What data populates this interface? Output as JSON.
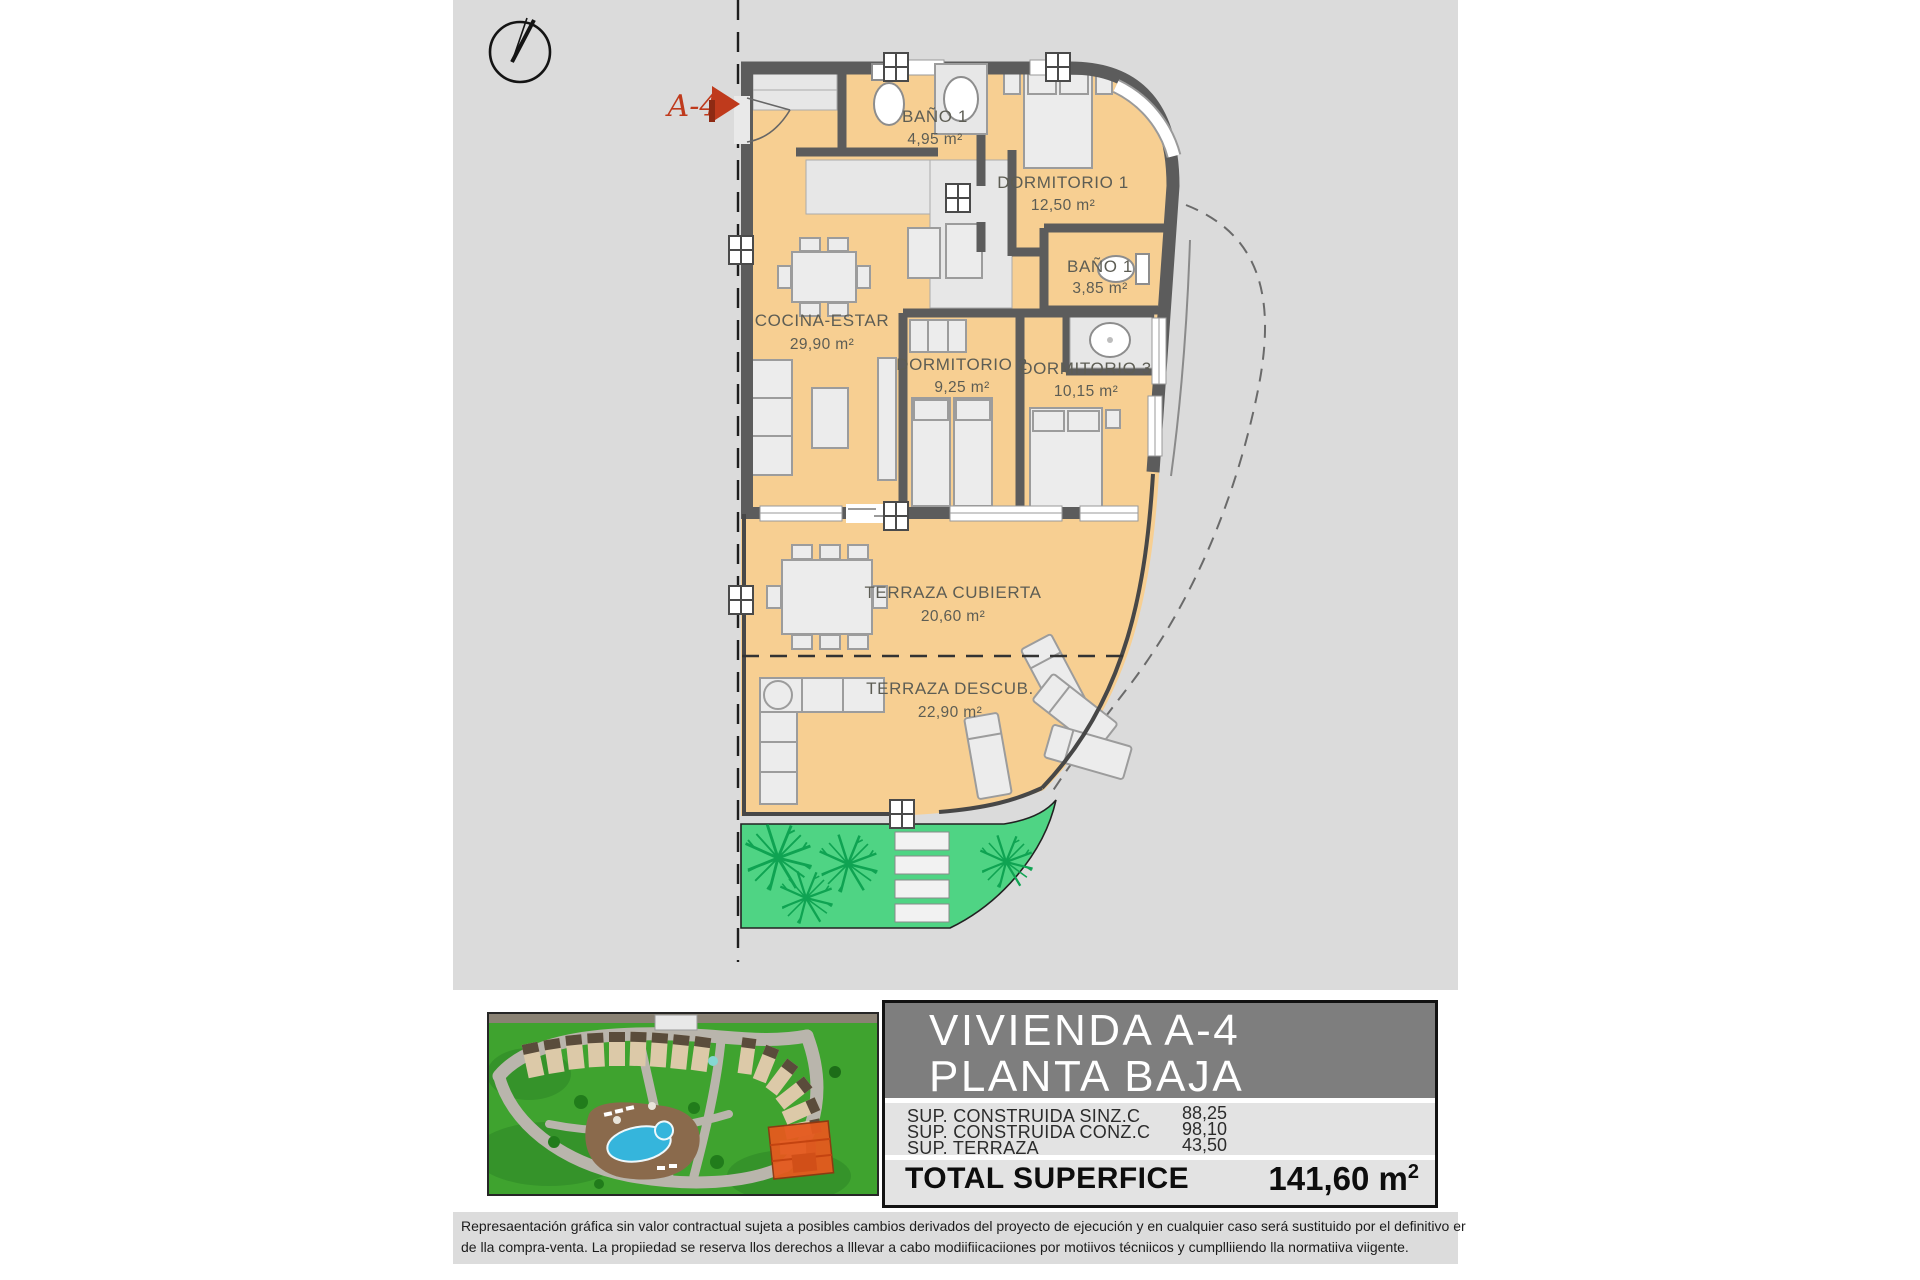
{
  "colors": {
    "site_background": "#dbdbdb",
    "wall": "#5c5c5c",
    "floor_orange": "#f7cf92",
    "corridor_gray": "#e7e7e7",
    "garden_green": "#4fd484",
    "plant_green": "#0fa352",
    "marker_red": "#bf3a1c",
    "panel_header_gray": "#7e7e7e"
  },
  "marker": {
    "label": "A-4"
  },
  "rooms": [
    {
      "name": "BAÑO 1",
      "area": "4,95 m²"
    },
    {
      "name": "DORMITORIO 1",
      "area": "12,50 m²"
    },
    {
      "name": "BAÑO 1",
      "area": "3,85 m²"
    },
    {
      "name": "COCINA-ESTAR",
      "area": "29,90 m²"
    },
    {
      "name": "DORMITORIO 2",
      "area": "9,25 m²"
    },
    {
      "name": "DORMITORIO 3",
      "area": "10,15 m²"
    },
    {
      "name": "TERRAZA CUBIERTA",
      "area": "20,60 m²"
    },
    {
      "name": "TERRAZA DESCUB.",
      "area": "22,90 m²"
    }
  ],
  "info_panel": {
    "title_line1": "VIVIENDA A-4",
    "title_line2": "PLANTA BAJA",
    "rows": [
      {
        "label": "SUP. CONSTRUIDA SINZ.C",
        "value": "88,25"
      },
      {
        "label": "SUP. CONSTRUIDA CONZ.C",
        "value": "98,10"
      },
      {
        "label": "SUP. TERRAZA",
        "value": "43,50"
      }
    ],
    "total_label": "TOTAL SUPERFICE",
    "total_value": "141,60 m",
    "total_value_sup": "2"
  },
  "disclaimer": {
    "line1": "Represaentación gráfica sin valor contractual sujeta a posibles cambios derivados del proyecto de ejecución y en cualquier caso será sustituido por el definitivo er",
    "line2": "de lla compra-venta. La propiiedad se reserva llos derechos a lllevar a cabo modiifiicaciiones por motiivos técniicos y cumplliiendo lla normatiiva viigente."
  }
}
